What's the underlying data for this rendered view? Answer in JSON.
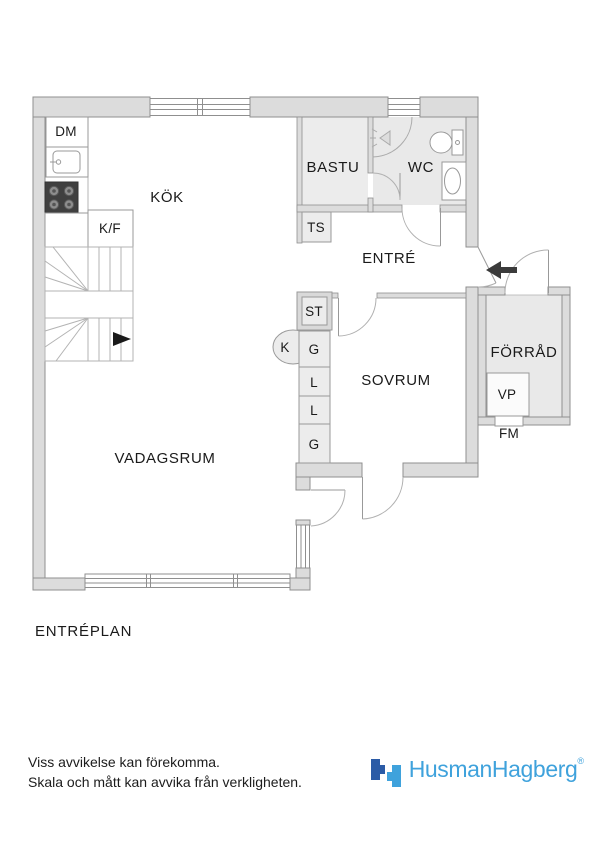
{
  "plan": {
    "title": "ENTRÉPLAN",
    "rooms": {
      "kitchen": "KÖK",
      "sauna": "BASTU",
      "wc": "WC",
      "hall": "ENTRÉ",
      "bedroom": "SOVRUM",
      "storage": "FÖRRÅD",
      "living_room": "VADAGSRUM"
    },
    "labels": {
      "dishwasher": "DM",
      "fridge_freezer": "K/F",
      "drying_cabinet": "TS",
      "cleaning_cabinet": "ST",
      "chimney": "K",
      "wardrobe_top": "G",
      "linen_upper": "L",
      "linen_lower": "L",
      "wardrobe_bottom": "G",
      "heat_pump": "VP",
      "meter_cabinet": "FM"
    },
    "symbols": {
      "entrance_arrow_direction": "left",
      "stair_arrow_direction": "right"
    }
  },
  "footer": {
    "disclaimer_line1": "Viss avvikelse kan förekomma.",
    "disclaimer_line2": "Skala och mått kan avvika från verkligheten.",
    "brand_name": "HusmanHagberg",
    "registered_mark": "®"
  },
  "colors": {
    "wall_fill": "#dcdcdc",
    "wall_stroke": "#8f8f8f",
    "fixture_fill": "#ececec",
    "wet_room_floor": "#e9e9e9",
    "stove_fill": "#404040",
    "arrow_black": "#3b3b3b",
    "brand_dark_blue": "#2b5ba6",
    "brand_light_blue": "#3fa2dc"
  }
}
